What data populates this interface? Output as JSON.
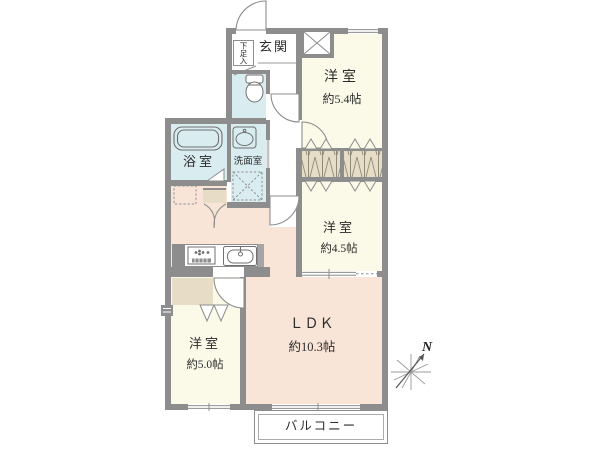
{
  "floorplan": {
    "rooms": {
      "entrance": {
        "label": "玄関"
      },
      "shoe_storage": {
        "label": "下足入"
      },
      "bathroom": {
        "label": "浴室"
      },
      "washroom": {
        "label": "洗面室"
      },
      "western_5_4": {
        "label": "洋室",
        "size": "約5.4帖"
      },
      "western_4_5": {
        "label": "洋室",
        "size": "約4.5帖"
      },
      "western_5_0": {
        "label": "洋室",
        "size": "約5.0帖"
      },
      "ldk": {
        "label": "ＬＤＫ",
        "size": "約10.3帖"
      },
      "balcony": {
        "label": "バルコニー"
      }
    },
    "compass": {
      "label": "N"
    },
    "colors": {
      "wall": "#8d8d8d",
      "western_room": "#fbfae9",
      "ldk": "#f9e5d7",
      "wet_area": "#d9edf0",
      "closet": "#e7dcc5",
      "background": "#ffffff"
    }
  }
}
